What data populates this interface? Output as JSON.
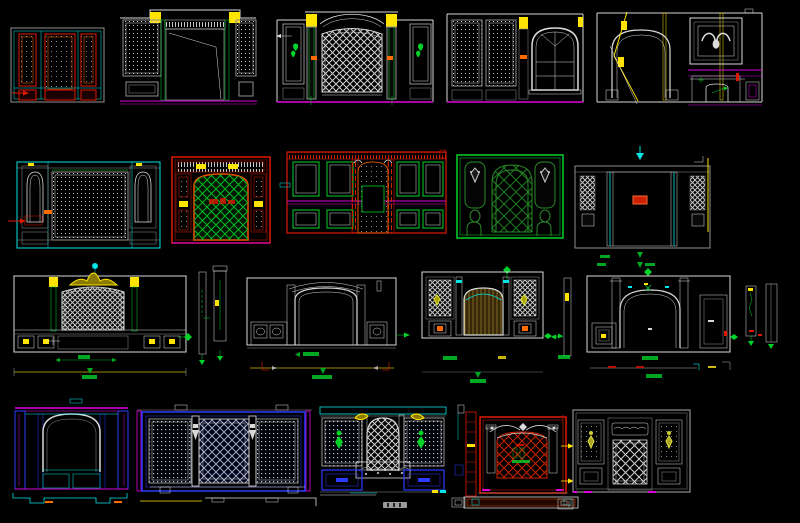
{
  "app": {
    "kind": "cad-drawing-canvas",
    "description": "Black CAD model-space sheet with 19 classical interior wall / backdrop elevation blocks arranged in 4 rows, plus narrow section-profile strips and dimension annotation marks. No legible text; one ~5px illegible caption blob under the fireplace elevation.",
    "background": "#000000"
  },
  "palette": {
    "bg": "#000000",
    "white": "#d9d9d9",
    "gray": "#8f8f8f",
    "cyan": "#00e5e5",
    "magenta": "#dd00dd",
    "red": "#e01800",
    "orange": "#ff6a00",
    "green": "#00d22a",
    "darkgreen": "#1e7d1e",
    "yellow": "#ffe400",
    "blue": "#2b3cff",
    "navy": "#9aa8c0",
    "gold": "#b8912c",
    "darkred": "#8a1a00"
  },
  "rows": [
    {
      "row": 1,
      "drawings": [
        "red-framed dotted panel wall",
        "doorway elevation with dotted side panels",
        "lattice wall with green heart ornaments",
        "wall with arched divided window",
        "arch opening + bull-skull picture + fireplace wall"
      ]
    },
    {
      "row": 2,
      "drawings": [
        "cyan-framed niche wall with dotted field",
        "red media wall with green diamond lattice",
        "red-framed wall with teal panels and arched TV niche",
        "green arched lattice window wall",
        "gray TV wall with lattice columns"
      ]
    },
    {
      "row": 3,
      "drawings": [
        "headboard wall with yellow crown and lattice",
        "two section profile strips",
        "arched opening elevation with dimension string",
        "slatted arch wall with lattice columns",
        "arched wall elevation with side panels",
        "two right section profile strips"
      ]
    },
    {
      "row": 4,
      "drawings": [
        "magenta/blue arched cabinet with cyan plinth",
        "blue lattice cabinet with dotted doors",
        "white fireplace wall with lattice arch",
        "red section ladder strip",
        "red lattice fireplace with base bar",
        "gray panel wall with floral ornaments"
      ]
    }
  ],
  "annotations": {
    "dimension_marks": "green arrows, diamonds and tick blobs; yellow and white dimension strings below row-3 and row-4 blocks",
    "tiny_caption": "illegible 5px white caption under fireplace wall (rendered as blur blob)",
    "legend_boxes": "two tiny white rectangle glyph boxes near bottom of sheet"
  }
}
